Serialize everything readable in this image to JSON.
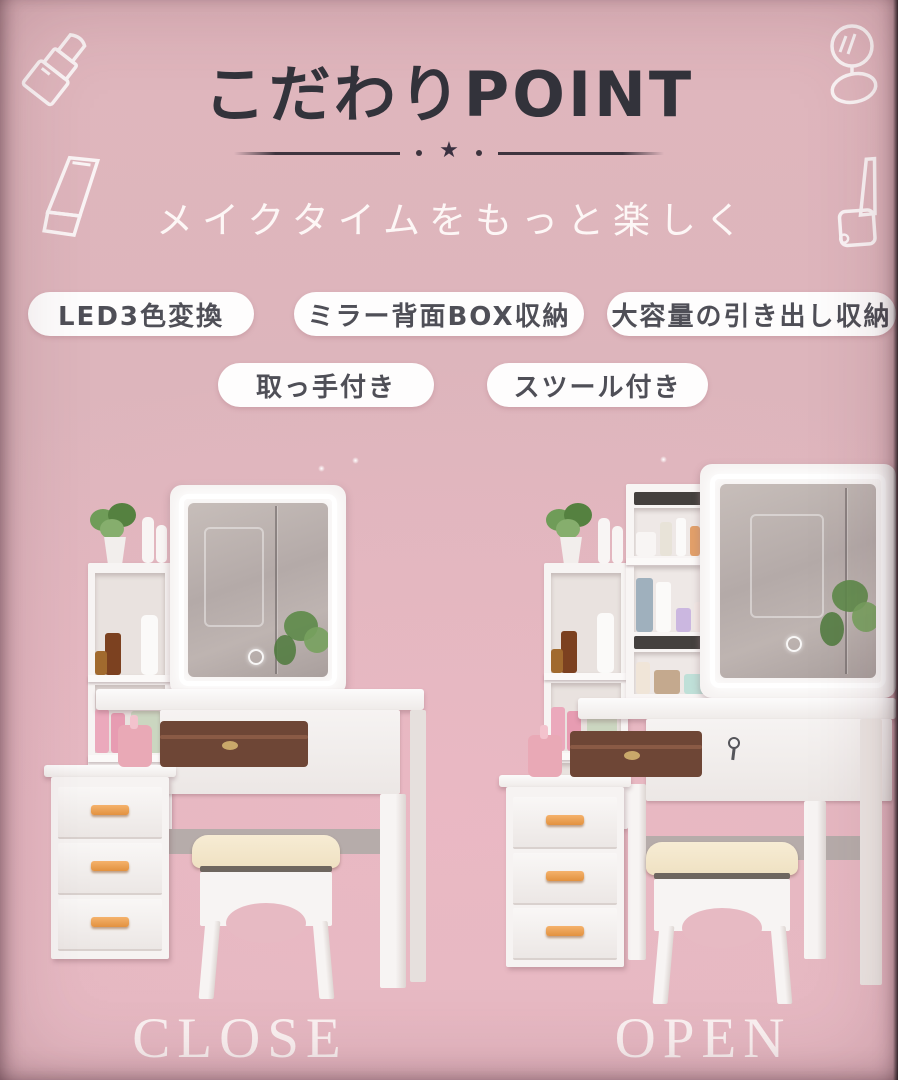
{
  "header": {
    "title": "こだわりPOINT",
    "subtitle": "メイクタイムをもっと楽しく",
    "divider_star": "★",
    "divider_dots": "·"
  },
  "features": {
    "row1": [
      "LED3色変換",
      "ミラー背面BOX収納",
      "大容量の引き出し収納"
    ],
    "row2": [
      "取っ手付き",
      "スツール付き"
    ]
  },
  "products": [
    {
      "label": "CLOSE"
    },
    {
      "label": "OPEN"
    }
  ],
  "decor_icons": [
    "lipstick-icon",
    "compact-mirror-icon",
    "cosmetic-tube-icon",
    "nail-polish-icon"
  ],
  "colors": {
    "background_pink": "#ddb5bc",
    "title_text": "#33333b",
    "badge_background": "#fefdfd",
    "badge_text": "#4f4f57",
    "caption_text": "#fbf2f2",
    "led_glow": "#ffffff",
    "drawer_handle": "#e2913f",
    "stool_cushion": "#f3e7cd"
  }
}
